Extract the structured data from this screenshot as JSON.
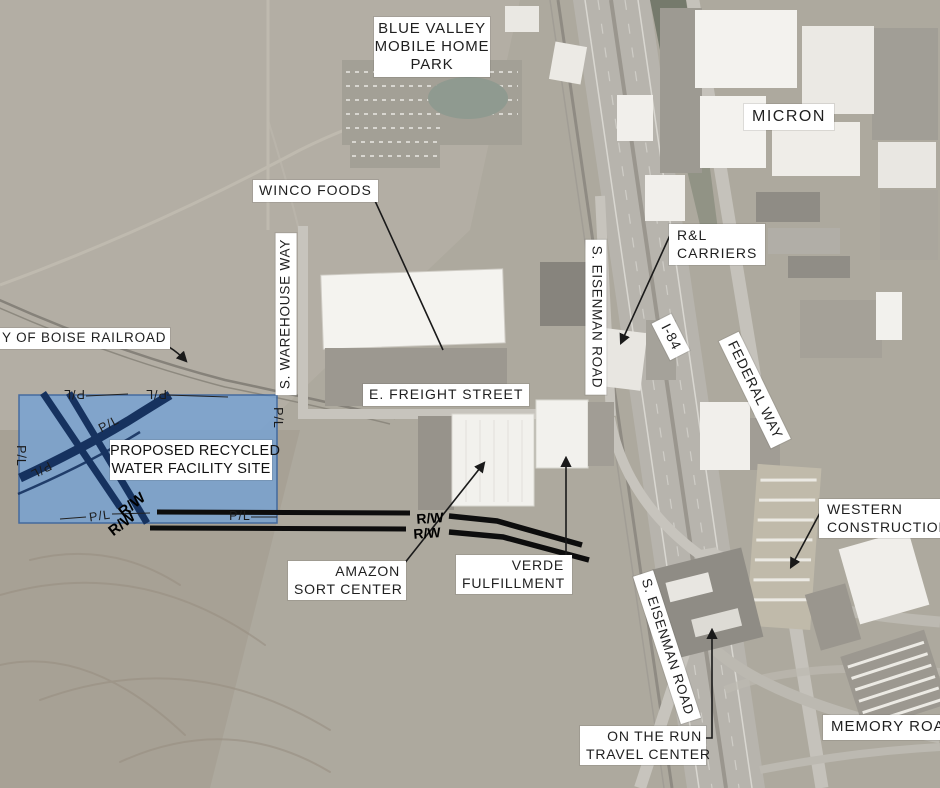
{
  "figure": {
    "title": "PROPOSED RECYCLED WATER FACILITY SITE",
    "type": "aerial site location map"
  },
  "site": {
    "lines": [
      "PROPOSED RECYCLED",
      "WATER FACILITY SITE"
    ],
    "fill_color": "#79A3D2",
    "rail_line_color": "#16325F"
  },
  "labels": {
    "blue_valley": {
      "lines": [
        "BLUE VALLEY",
        "MOBILE HOME",
        "PARK"
      ]
    },
    "micron": {
      "text": "MICRON"
    },
    "winco": {
      "text": "WINCO FOODS"
    },
    "warehouse_way": {
      "text": "S. WAREHOUSE WAY"
    },
    "eisenman_north": {
      "text": "S. EISENMAN ROAD"
    },
    "rl_carriers": {
      "lines": [
        "R&L",
        "CARRIERS"
      ]
    },
    "i84": {
      "text": "I-84"
    },
    "federal_way": {
      "text": "FEDERAL WAY"
    },
    "boise_railroad": {
      "text": "Y OF BOISE RAILROAD"
    },
    "freight_street": {
      "text": "E. FREIGHT STREET"
    },
    "amazon": {
      "lines": [
        "AMAZON",
        "SORT CENTER"
      ]
    },
    "verde": {
      "lines": [
        "VERDE",
        "FULFILLMENT"
      ]
    },
    "western": {
      "lines": [
        "WESTERN",
        "CONSTRUCTION"
      ]
    },
    "eisenman_south": {
      "text": "S. EISENMAN ROAD"
    },
    "on_the_run": {
      "lines": [
        "ON THE RUN",
        "TRAVEL CENTER"
      ]
    },
    "memory_road": {
      "text": "MEMORY ROAD"
    }
  },
  "markers": {
    "property_line": "P/L",
    "right_of_way": "R/W"
  },
  "colors": {
    "terrain": "#ADA99E",
    "label_bg": "#FFFFFF",
    "label_text": "#1F1F1F",
    "annotation_line": "#111111"
  }
}
